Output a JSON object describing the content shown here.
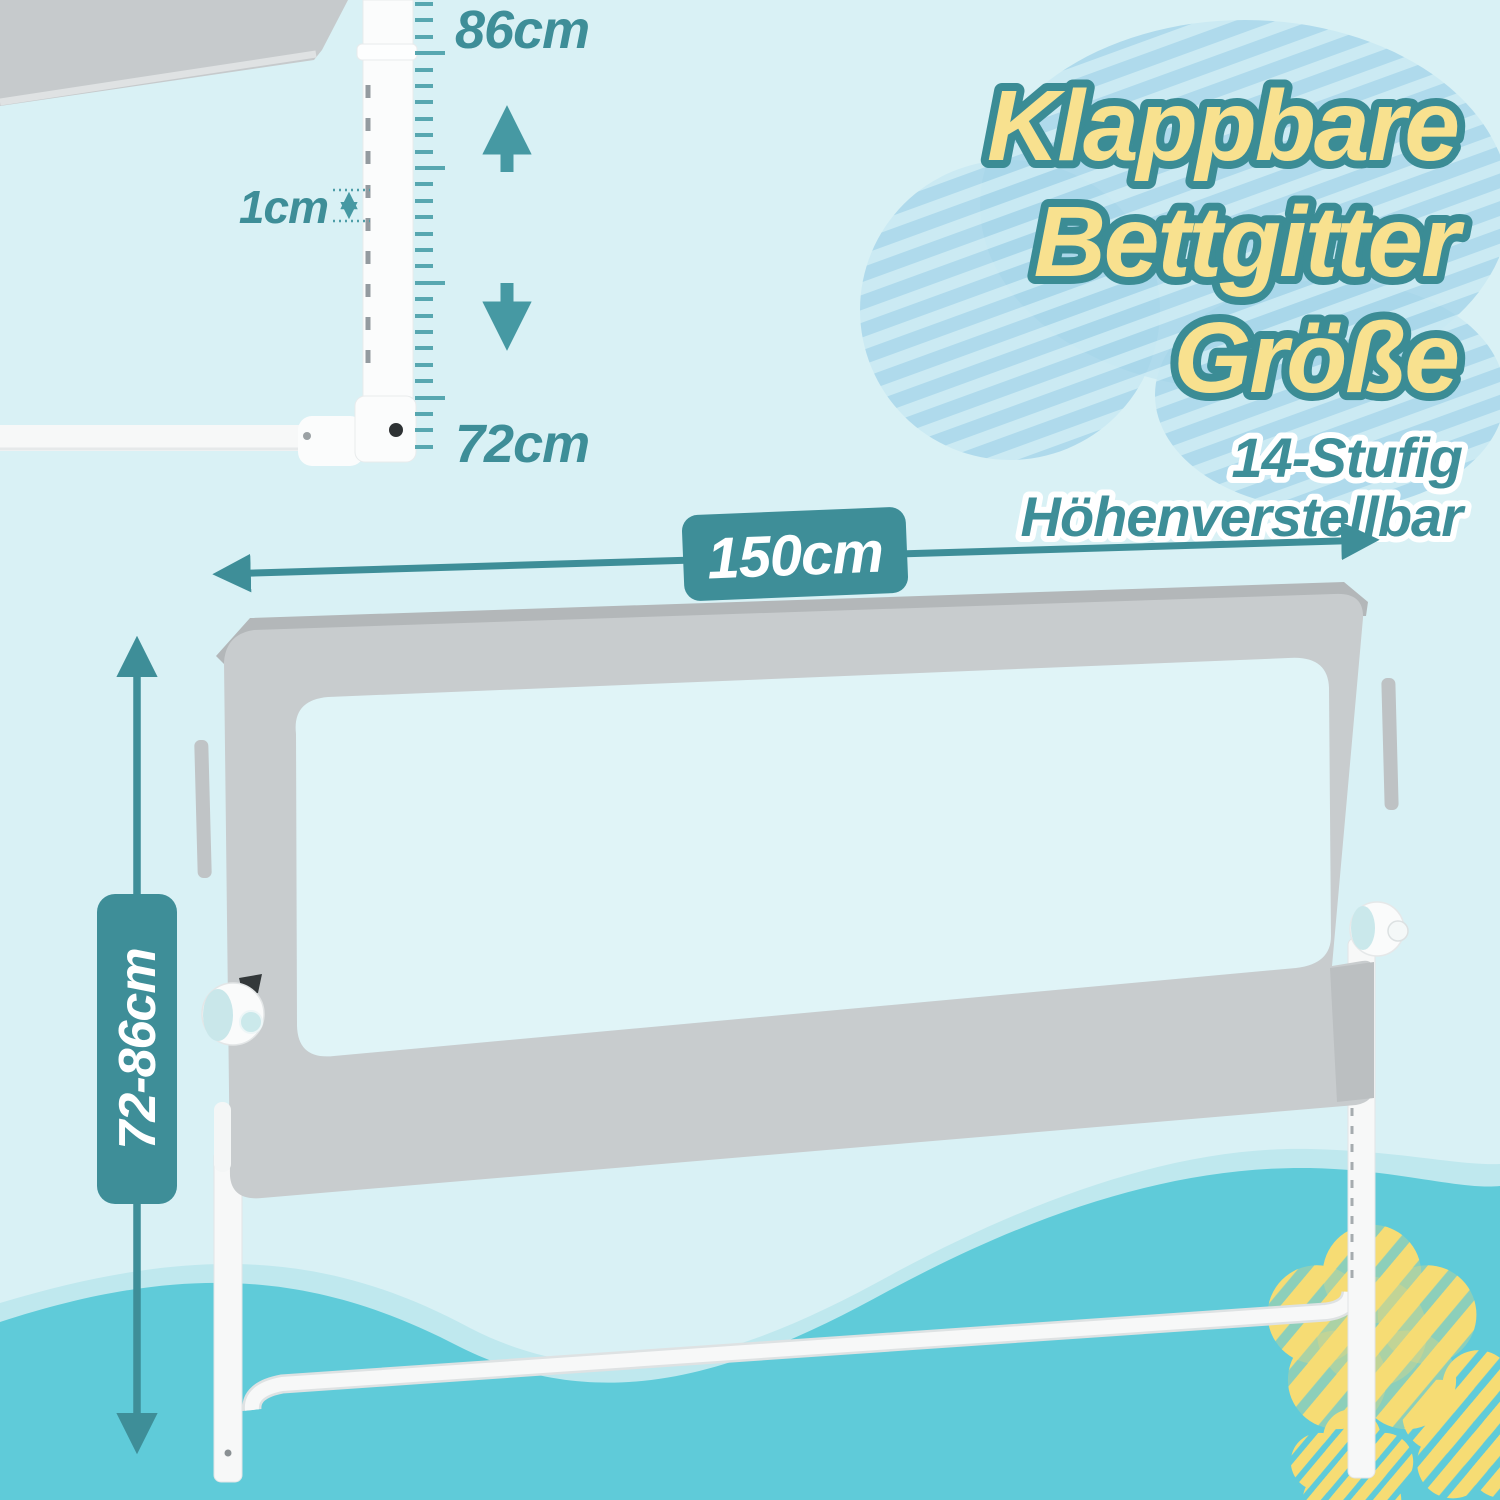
{
  "title": {
    "line1": "Klappbare",
    "line2": "Bettgitter",
    "line3": "Größe",
    "subtitle_line1": "14-Stufig",
    "subtitle_line2": "Höhenverstellbar"
  },
  "measurements": {
    "max_height": "86cm",
    "adjustment_step": "1cm",
    "min_height": "72cm",
    "rail_length": "150cm",
    "height_range": "72-86cm"
  },
  "colors": {
    "background": "#D9F1F5",
    "accent_teal": "#3E8E98",
    "arrow_teal": "#4699A3",
    "title_yellow": "#F8E18F",
    "title_outline": "#3B8C95",
    "wave_main": "#5FCBD9",
    "wave_light": "#BFE8EE",
    "cloud_stripe": "#A8D6EA",
    "flower_yellow": "#F6DC74",
    "rail_gray": "#C8CCCE",
    "frame_white": "#FAFBFB"
  }
}
